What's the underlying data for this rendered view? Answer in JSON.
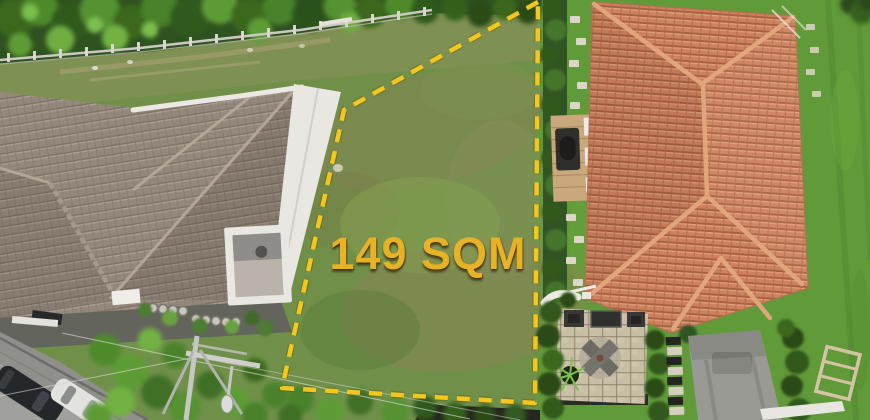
{
  "overlay": {
    "area_label": "149 SQM",
    "label_color": "#E8B226",
    "boundary_color": "#F2C81E"
  },
  "palette": {
    "lot_grass": "#70904A",
    "right_lawn": "#619A39",
    "trees_dark": "#2E5220",
    "left_roof_tile": "#94887C",
    "right_roof_tile": "#CD8160",
    "white_trim": "#E9E7E1",
    "road_asphalt": "#8F908C",
    "deck_wood": "#C9A87B",
    "patio_paver": "#C9BFA6"
  }
}
